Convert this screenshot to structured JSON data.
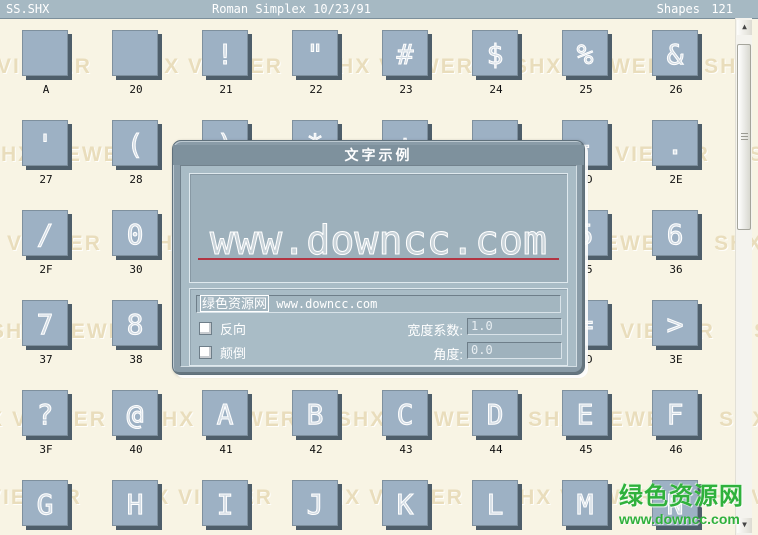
{
  "window": {
    "left_title": "SS.SHX",
    "center_title": "Roman Simplex 10/23/91",
    "right_label": "Shapes",
    "count": "121"
  },
  "watermark": {
    "text": "SHX VIEWER"
  },
  "site": {
    "name": "绿色资源网",
    "url": "www.downcc.com"
  },
  "grid": {
    "cells": [
      {
        "glyph": "",
        "label": "A"
      },
      {
        "glyph": "",
        "label": "20"
      },
      {
        "glyph": "!",
        "label": "21"
      },
      {
        "glyph": "\"",
        "label": "22"
      },
      {
        "glyph": "#",
        "label": "23"
      },
      {
        "glyph": "$",
        "label": "24"
      },
      {
        "glyph": "%",
        "label": "25"
      },
      {
        "glyph": "&",
        "label": "26"
      },
      {
        "glyph": "'",
        "label": "27"
      },
      {
        "glyph": "(",
        "label": "28"
      },
      {
        "glyph": ")",
        "label": "29"
      },
      {
        "glyph": "*",
        "label": "2A"
      },
      {
        "glyph": "+",
        "label": "2B"
      },
      {
        "glyph": ",",
        "label": "2C"
      },
      {
        "glyph": "-",
        "label": "2D"
      },
      {
        "glyph": ".",
        "label": "2E"
      },
      {
        "glyph": "/",
        "label": "2F"
      },
      {
        "glyph": "0",
        "label": "30"
      },
      {
        "glyph": "1",
        "label": "31"
      },
      {
        "glyph": "2",
        "label": "32"
      },
      {
        "glyph": "3",
        "label": "33"
      },
      {
        "glyph": "4",
        "label": "34"
      },
      {
        "glyph": "5",
        "label": "35"
      },
      {
        "glyph": "6",
        "label": "36"
      },
      {
        "glyph": "7",
        "label": "37"
      },
      {
        "glyph": "8",
        "label": "38"
      },
      {
        "glyph": "9",
        "label": "39"
      },
      {
        "glyph": ":",
        "label": "3A"
      },
      {
        "glyph": ";",
        "label": "3B"
      },
      {
        "glyph": "<",
        "label": "3C"
      },
      {
        "glyph": "=",
        "label": "3D"
      },
      {
        "glyph": ">",
        "label": "3E"
      },
      {
        "glyph": "?",
        "label": "3F"
      },
      {
        "glyph": "@",
        "label": "40"
      },
      {
        "glyph": "A",
        "label": "41"
      },
      {
        "glyph": "B",
        "label": "42"
      },
      {
        "glyph": "C",
        "label": "43"
      },
      {
        "glyph": "D",
        "label": "44"
      },
      {
        "glyph": "E",
        "label": "45"
      },
      {
        "glyph": "F",
        "label": "46"
      },
      {
        "glyph": "G",
        "label": ""
      },
      {
        "glyph": "H",
        "label": ""
      },
      {
        "glyph": "I",
        "label": ""
      },
      {
        "glyph": "J",
        "label": ""
      },
      {
        "glyph": "K",
        "label": ""
      },
      {
        "glyph": "L",
        "label": ""
      },
      {
        "glyph": "M",
        "label": ""
      },
      {
        "glyph": "N",
        "label": ""
      }
    ]
  },
  "dialog": {
    "title": "文字示例",
    "preview_text": "www.downcc.com",
    "sample": {
      "selected": "绿色资源网",
      "rest": " www.downcc.com"
    },
    "checkboxes": [
      {
        "label": "反向",
        "checked": false
      },
      {
        "label": "颠倒",
        "checked": false
      }
    ],
    "fields": [
      {
        "label": "宽度系数:",
        "value": "1.0"
      },
      {
        "label": "角度:",
        "value": "0.0"
      }
    ]
  },
  "colors": {
    "bg": "#f8f4e4",
    "topbar": "#a6b9c3",
    "cellFace": "#9db1c4",
    "cellShadow": "#4e5e6a",
    "dialogFrame": "#8a9ca8",
    "dialogTitle": "#7e919d",
    "dialogBody": "#a9bcc6",
    "preview": "#9db0bb",
    "redline": "#b23543",
    "watermark": "#e9ddbc",
    "green": "#2fb13c",
    "scrollTrack": "#f4f3ee"
  }
}
